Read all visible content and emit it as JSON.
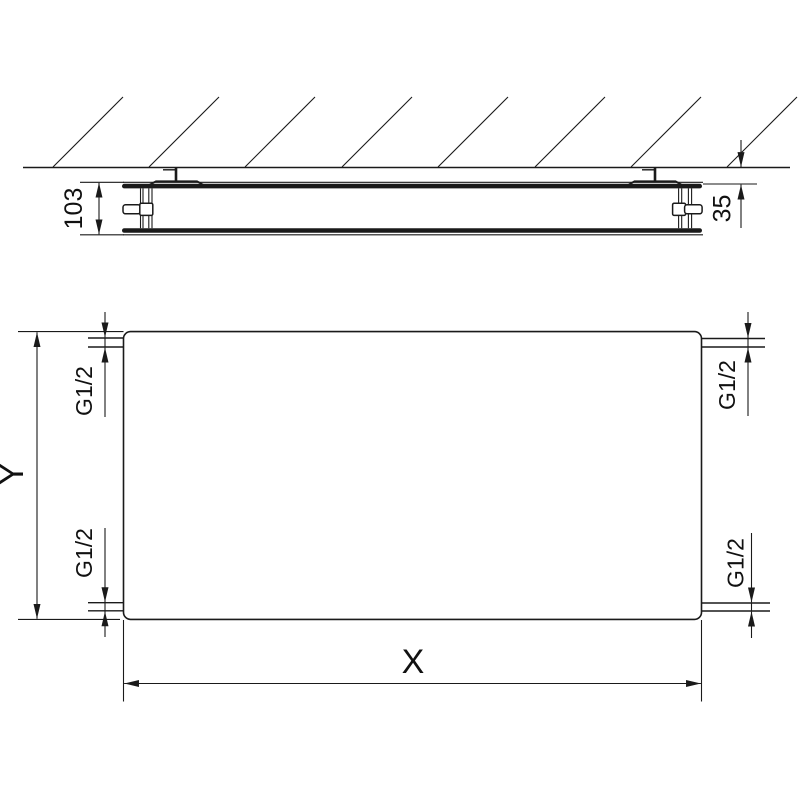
{
  "side_view": {
    "depth_label": "103",
    "wall_distance_label": "35"
  },
  "front_view": {
    "width_label": "X",
    "height_label": "Y",
    "connections": {
      "top_left": "G1/2",
      "top_right": "G1/2",
      "bottom_left": "G1/2",
      "bottom_right": "G1/2"
    }
  },
  "colors": {
    "line": "#1a1a1a",
    "label": "#111111",
    "background": "#ffffff"
  }
}
